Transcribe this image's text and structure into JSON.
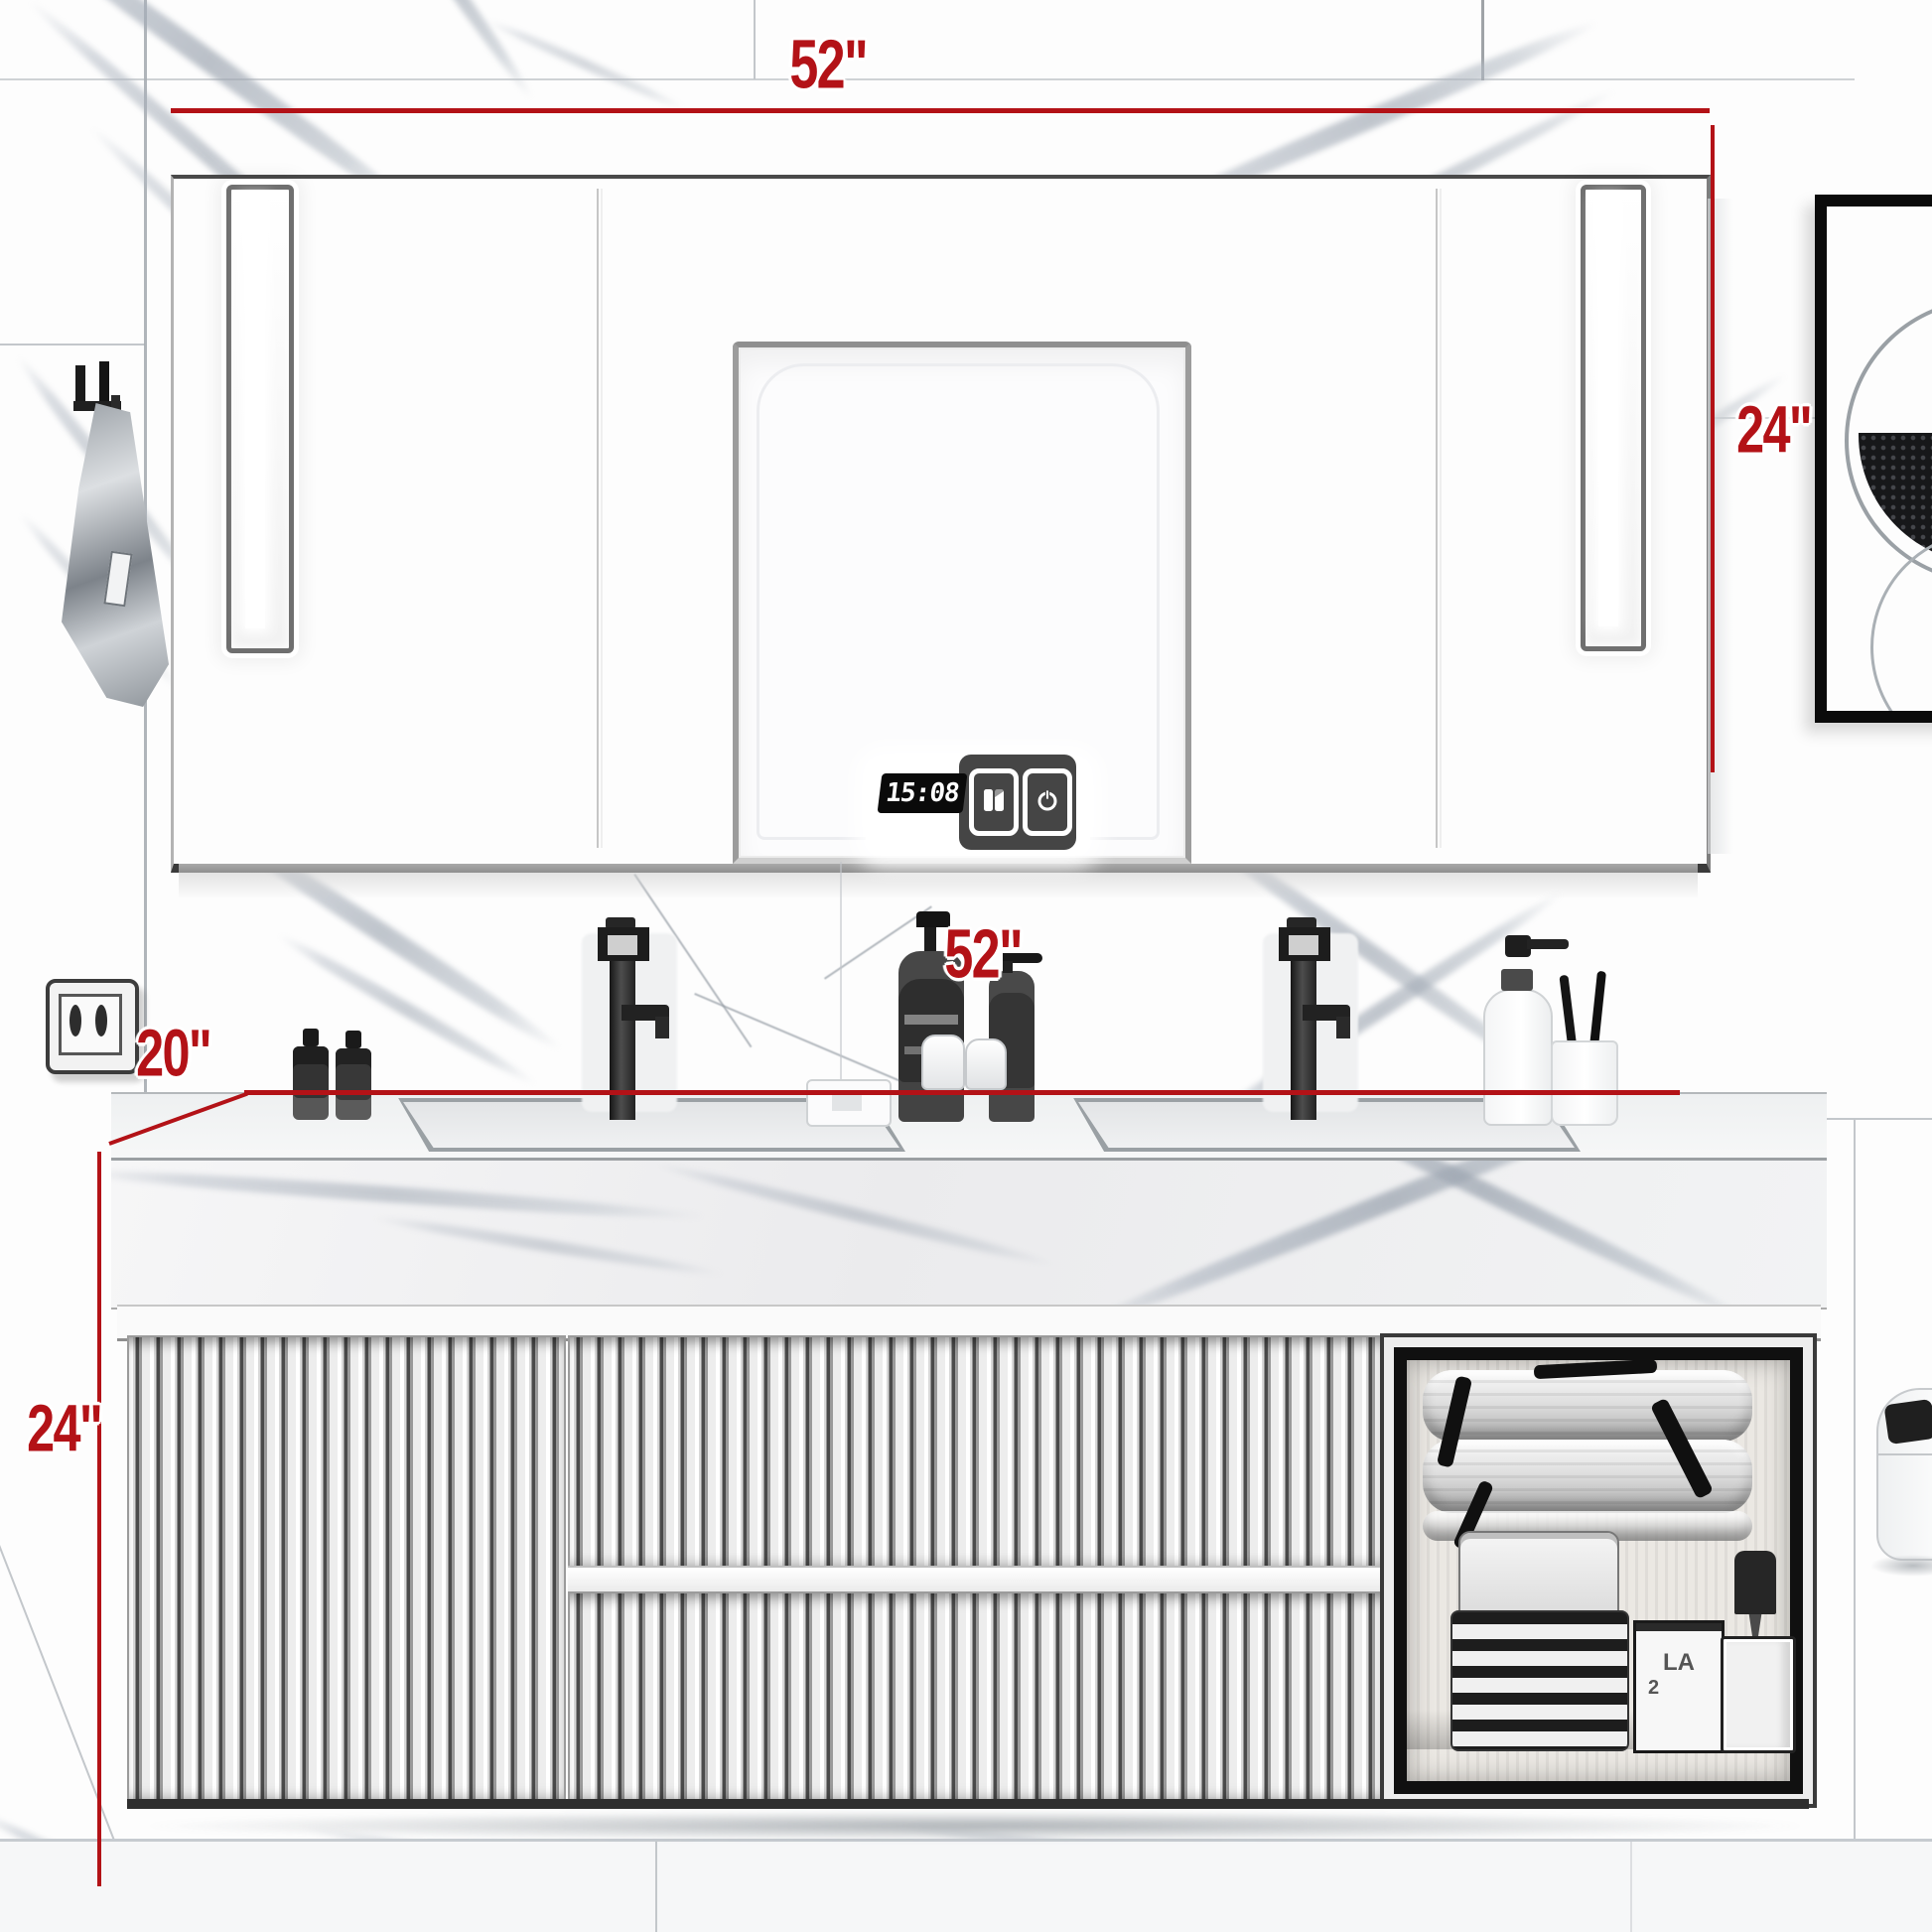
{
  "title": "Bathroom vanity with LED mirror cabinet - dimension illustration",
  "dims": {
    "accent_color": "#b31217",
    "mirror_width": "52\"",
    "mirror_height": "24\"",
    "counter_width": "52\"",
    "counter_depth": "20\"",
    "vanity_height": "24\""
  },
  "cabinet": {
    "clock_time": "15:08",
    "touch_buttons": [
      "defog-icon",
      "power-icon"
    ]
  },
  "niche": {
    "box_label_1": "LA",
    "box_label_2": "2"
  }
}
